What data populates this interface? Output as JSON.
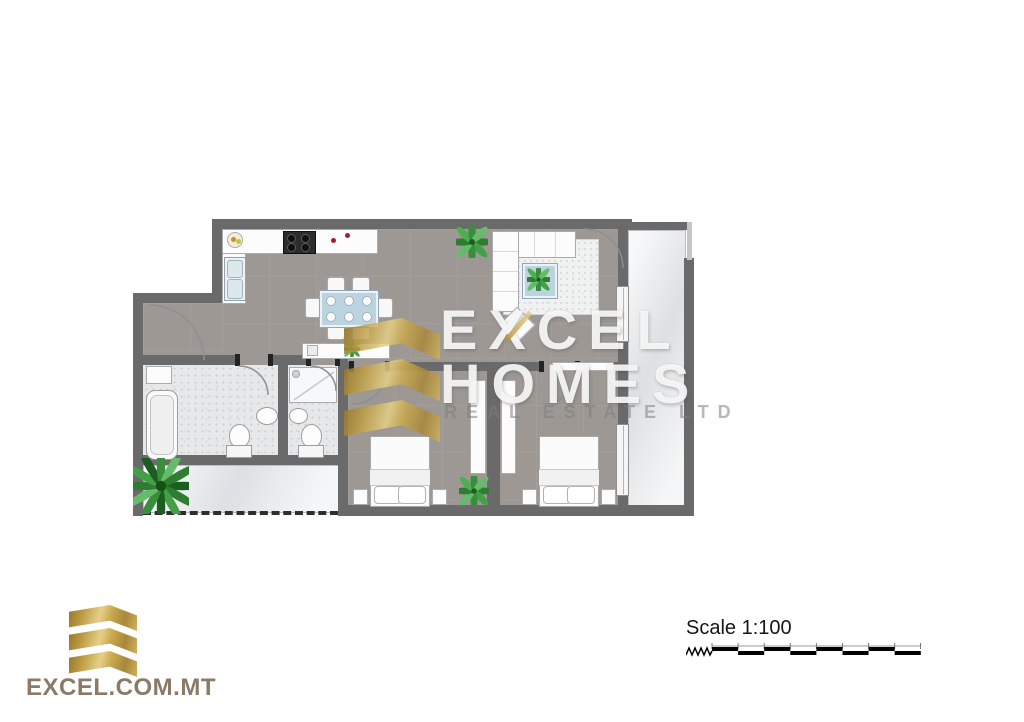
{
  "watermark": {
    "brand_line1": "EXCEL",
    "brand_line2": "HOMES",
    "brand_line3": "REAL ESTATE LTD"
  },
  "footer_logo": {
    "website": "EXCEL.COM.MT"
  },
  "scale_info": {
    "label": "Scale 1:100"
  },
  "colors": {
    "wall_gray": "#6a6a6a",
    "floor_taupe": "#9d9894",
    "marble_light": "#e9ebed",
    "brand_gold": "#c9a94e",
    "table_blue": "#bcd3e0",
    "plant_green": "#3a8d3e",
    "hob_red_accent": "#a11f30",
    "footer_text_brown": "#8a7a67"
  }
}
